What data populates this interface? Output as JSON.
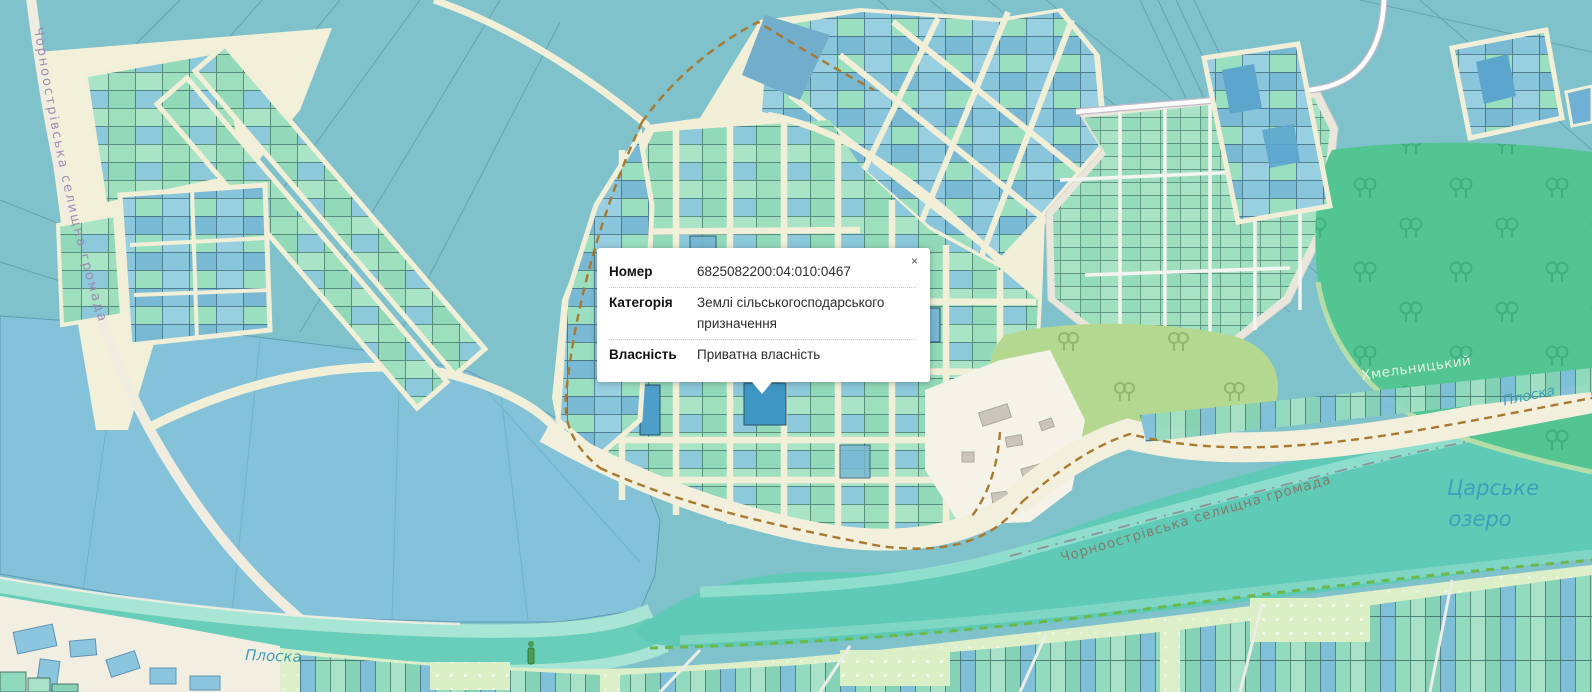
{
  "popup": {
    "close": "×",
    "fields": [
      {
        "label": "Номер",
        "value": "6825082200:04:010:0467"
      },
      {
        "label": "Категорія",
        "value": "Землі сільськогосподарського призначення"
      },
      {
        "label": "Власність",
        "value": "Приватна власність"
      }
    ]
  },
  "labels": {
    "hromada": "Чорноострівська селищна громада",
    "hromada_left": "Чорноострівська селищна громада",
    "lake_line1": "Царське",
    "lake_line2": "озеро",
    "river": "Плоска",
    "city": "Хмельницький"
  },
  "colors": {
    "field_teal": "#7FC2CC",
    "parcel_mint": "#9EDFBE",
    "parcel_blue": "#89C5DB",
    "selected_parcel": "#3E96C4",
    "road_cream": "#F2EFD8",
    "forest_green": "#52C593",
    "olive_green": "#B5D890",
    "water_teal": "#5FCAB6",
    "lake_blue": "#84C3D9",
    "boundary_dash": "#A9792F"
  }
}
